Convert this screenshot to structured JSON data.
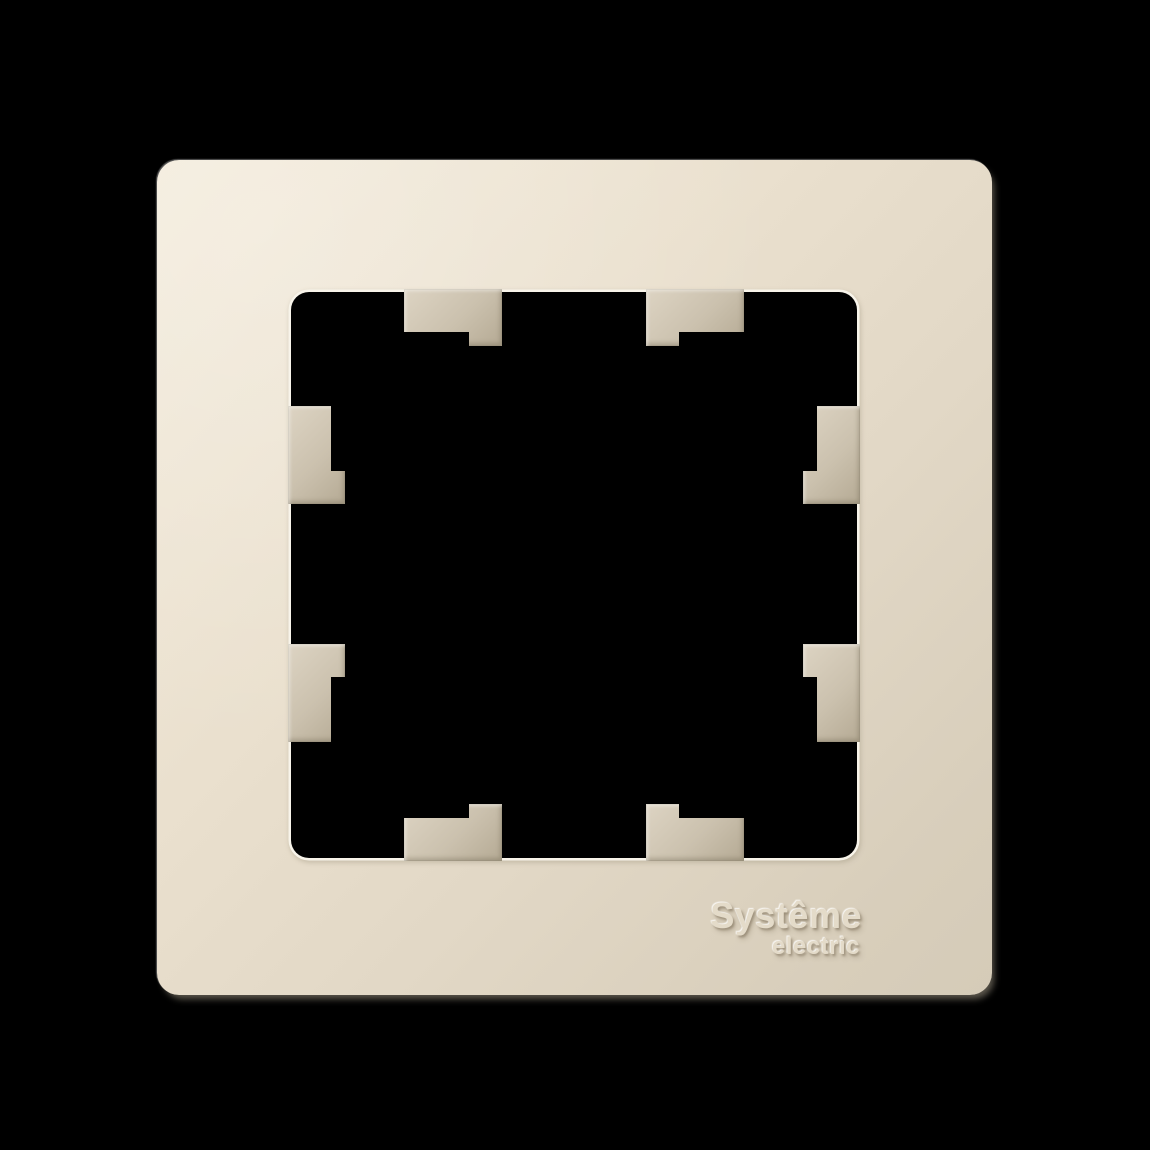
{
  "brand": {
    "line1": "Systême",
    "line2": "electric"
  },
  "colors": {
    "page_bg": "#000000",
    "frame_light": "#f3ebdb",
    "frame_mid": "#eae0ce",
    "frame_dark": "#d8cebb",
    "rim_highlight": "#f8f4ea",
    "tab_light": "#ddd4c3",
    "tab_mid": "#cbc1ae",
    "tab_dark": "#b5aa94",
    "opening_bg": "#000000",
    "logo_text": "#e4dbc9"
  }
}
